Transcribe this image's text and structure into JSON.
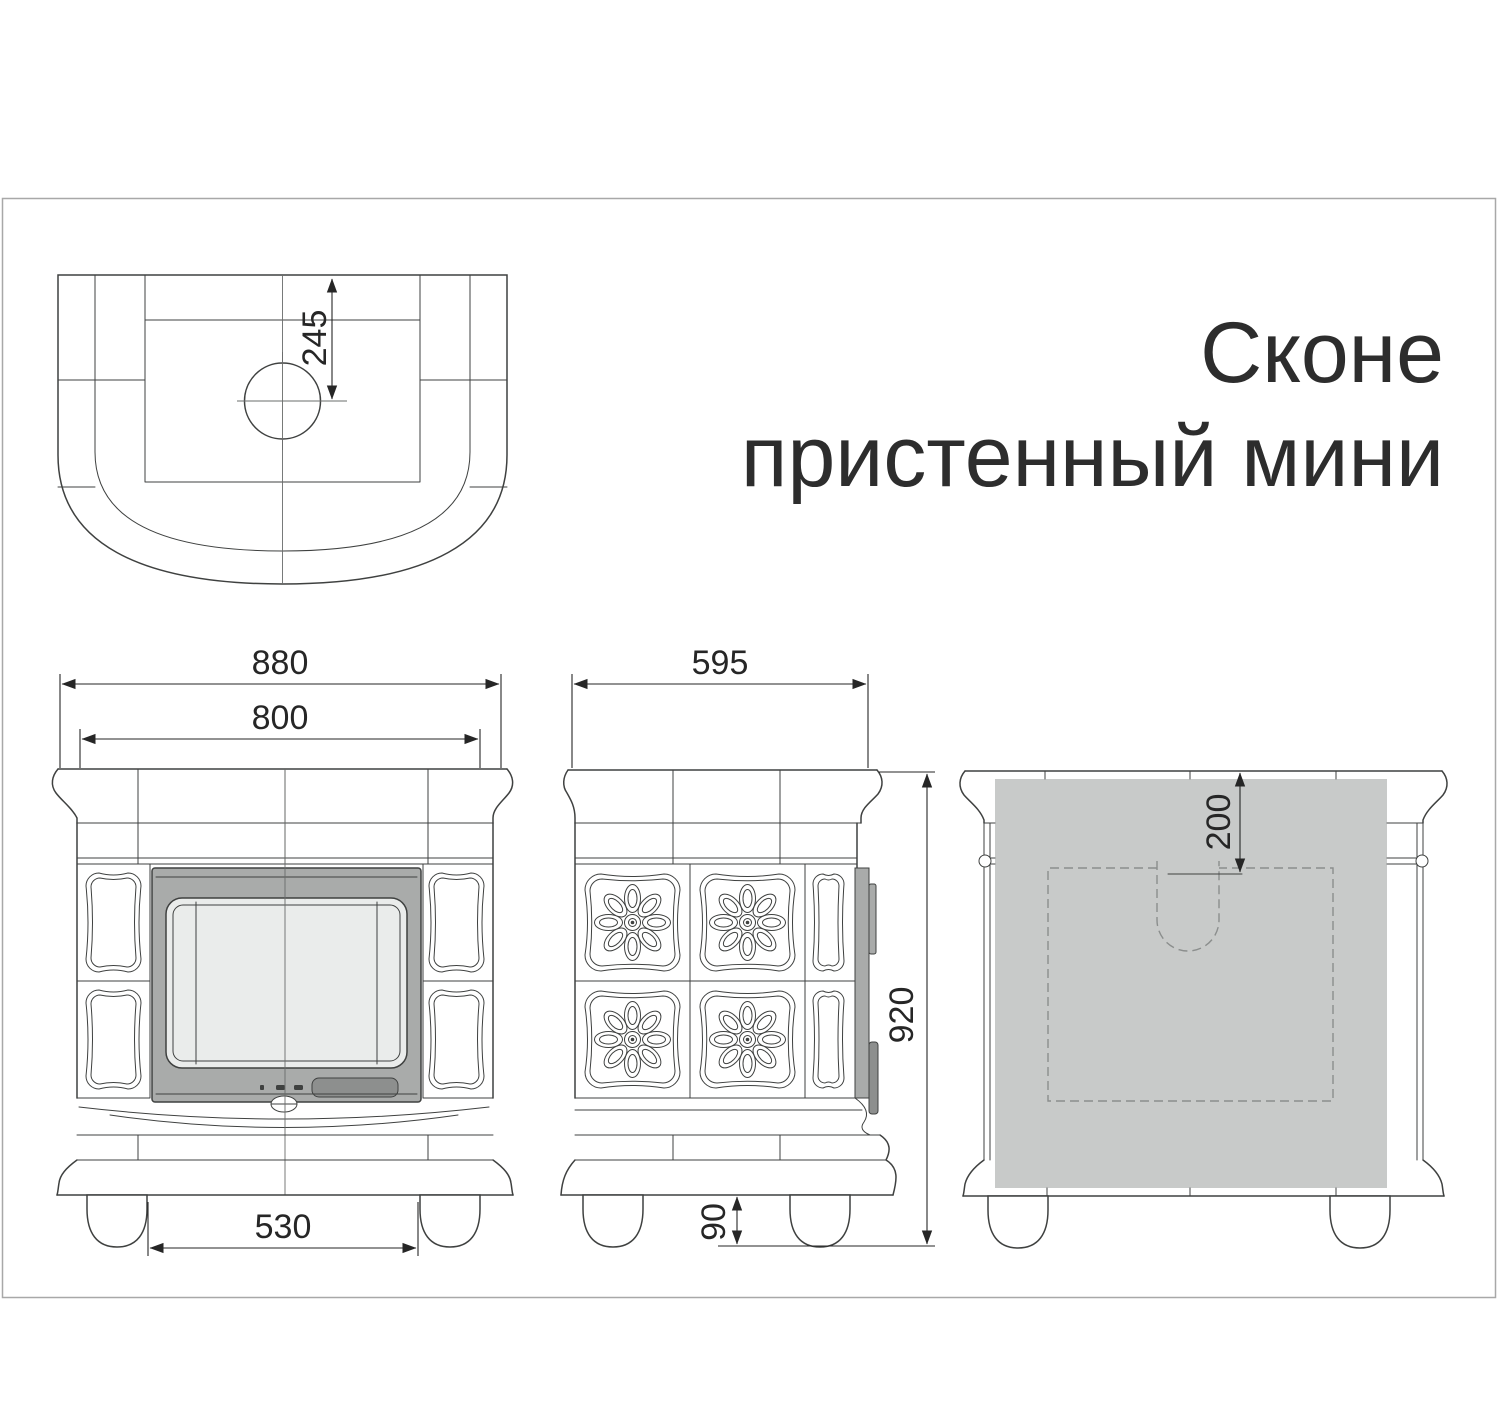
{
  "title": {
    "line1": "Сконе",
    "line2": "пристенный мини"
  },
  "dimensions": {
    "flue_center_from_front": "245",
    "overall_width": "880",
    "body_width": "800",
    "feet_inner_spacing": "530",
    "depth": "595",
    "overall_height": "920",
    "foot_height": "90",
    "shield_top_offset": "200"
  },
  "colors": {
    "drawing_line": "#3f4140",
    "dimension": "#262626",
    "door_frame": "#a9abaa",
    "glass": "#eaeceb",
    "handle_plate": "#8d8f8e",
    "back_heat_shield": "#c8cac9",
    "page_frame": "#a8a8a8",
    "background": "#ffffff"
  }
}
